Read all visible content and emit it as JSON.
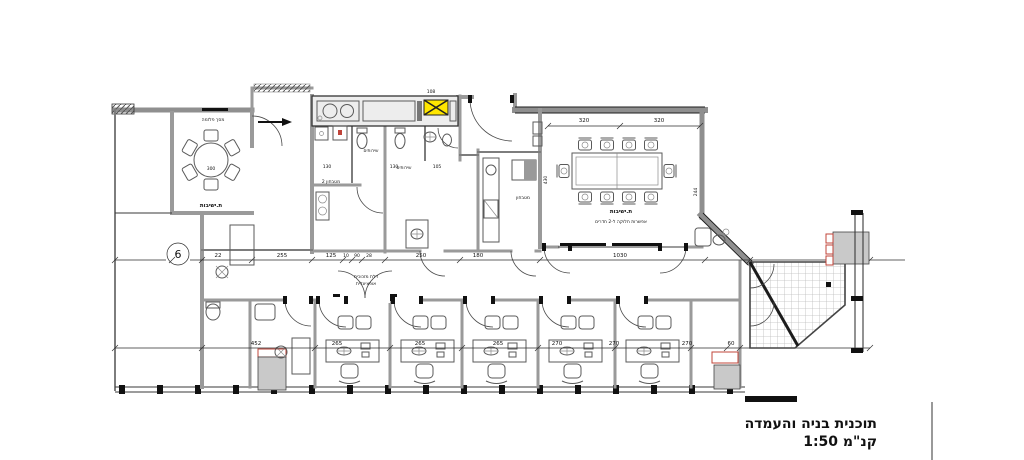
{
  "title": {
    "line1": "תוכנית בניה והעמדה",
    "line2": "קנ\"מ 1:50"
  },
  "grid_marker": "6",
  "labels": {
    "plasma": "מסך פלזמה",
    "meeting_small": "ת.ישיבות",
    "toilets_1": "שירותים",
    "toilets_2": "שירותים",
    "kitchenette_2": "מטבחון 2",
    "kitchenette": "מטבחון",
    "meeting_large_1": "ת.ישיבות",
    "meeting_large_2": "אפשרות חלוקה ל-2 חדרים",
    "glass_door_1": "דלת מזכוכית",
    "glass_door_2": "אופציונלית"
  },
  "dimensions": {
    "top": [
      "320",
      "320"
    ],
    "mid": [
      "22",
      "255",
      "125",
      "10",
      "90",
      "28",
      "250",
      "180",
      "1030"
    ],
    "bottom": [
      "452",
      "265",
      "265",
      "265",
      "270",
      "270",
      "270",
      "60"
    ],
    "misc": [
      "300",
      "108",
      "130",
      "130",
      "105",
      "430",
      "244"
    ]
  },
  "colors": {
    "wall_gray": "#8f8f8f",
    "line_dark": "#1c1c1c",
    "furniture": "#5a5a5a",
    "accent_red": "#c0443a",
    "accent_yellow": "#ffe600",
    "cabinet_gray": "#c9c9c9",
    "tile_line": "#bcbcbc"
  }
}
